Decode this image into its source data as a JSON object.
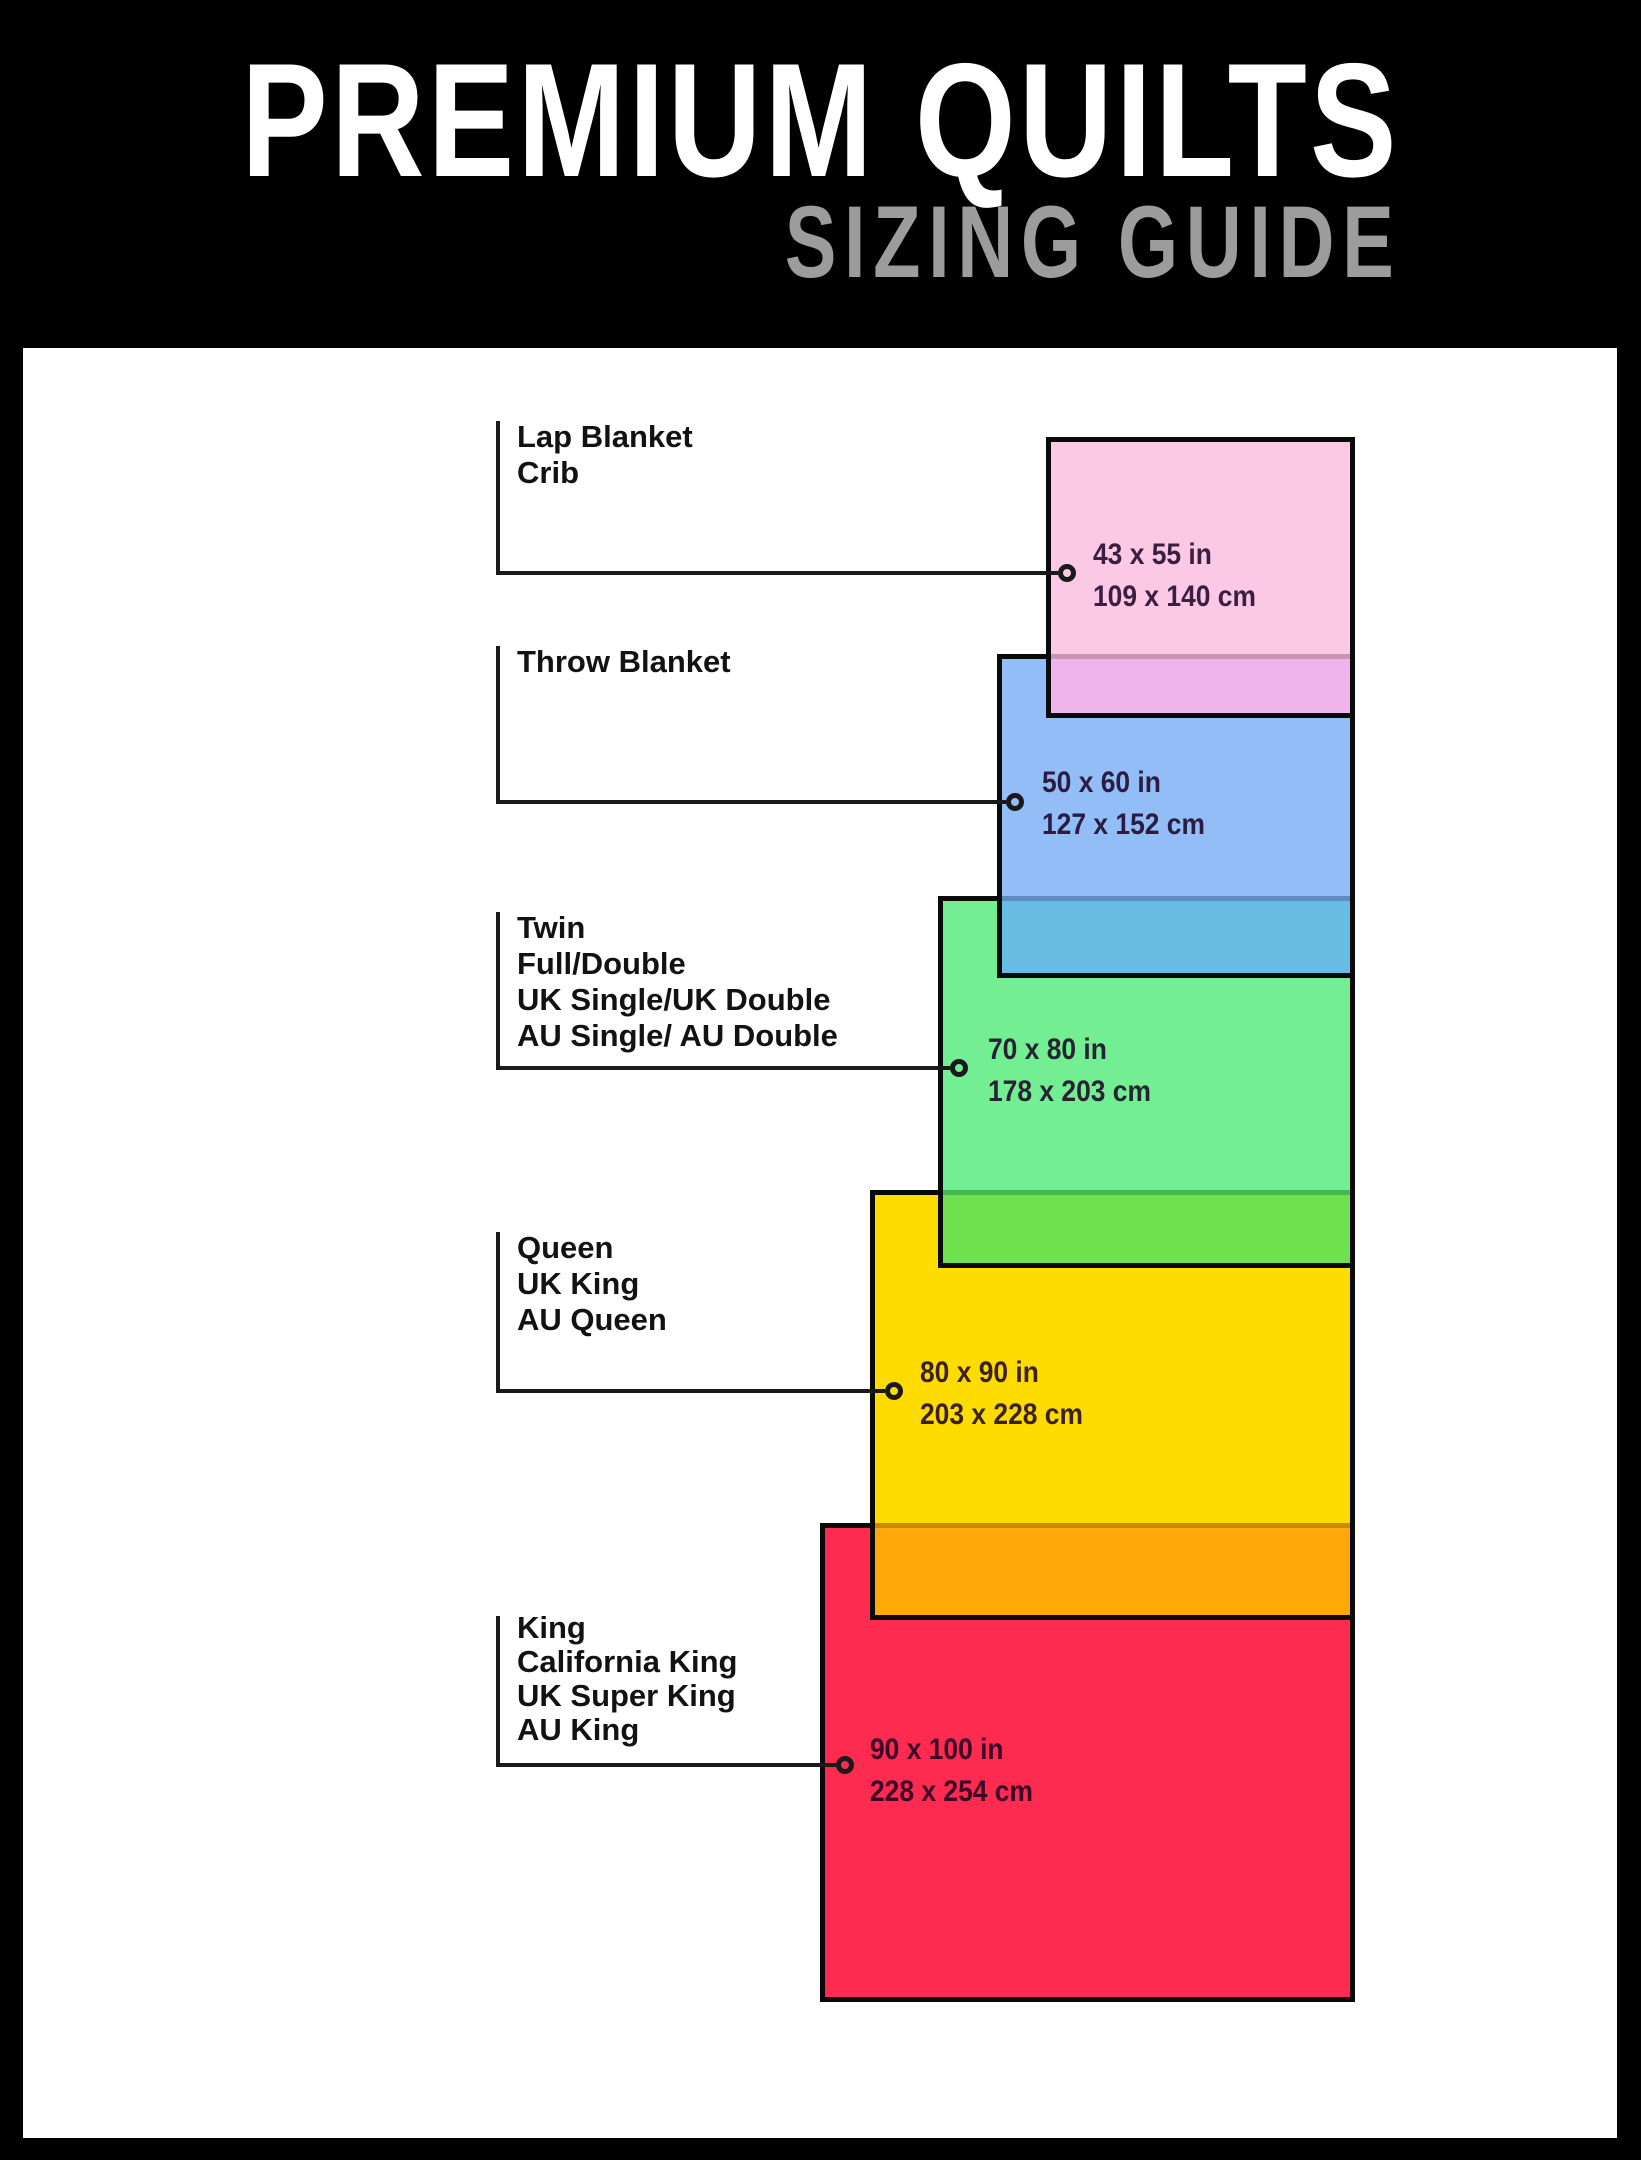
{
  "header": {
    "title": "PREMIUM QUILTS",
    "subtitle": "SIZING GUIDE"
  },
  "colors": {
    "page_background": "#000000",
    "panel_background": "#ffffff",
    "title_text": "#ffffff",
    "subtitle_text": "#9c9c9c",
    "label_text": "#121212",
    "connector_line": "#1a1a1a",
    "rect_border": "#0a0a0a"
  },
  "sizes": [
    {
      "id": "lap-blanket-crib",
      "labels": [
        "Lap Blanket",
        "Crib"
      ],
      "inches": "43 x 55 in",
      "cm": "109 x 140 cm",
      "fill": "#FBC9E6",
      "overlap_fill": "#F0B4EC",
      "overlap_divider": "#C896B3",
      "rect_px": {
        "x": 1046,
        "y": 437,
        "w": 309,
        "h": 281
      },
      "layout_px": {
        "label_top": 419,
        "label_line_height": 36,
        "vline_top": 421,
        "connector_y": 573,
        "circle_x": 1067,
        "dim_x": 1093,
        "dim_top": 534
      }
    },
    {
      "id": "throw-blanket",
      "labels": [
        "Throw Blanket"
      ],
      "inches": "50 x 60 in",
      "cm": "127 x 152 cm",
      "fill": "#92BDF6",
      "overlap_fill": "#68BBE2",
      "overlap_divider": "#5F8AC3",
      "rect_px": {
        "x": 997,
        "y": 654,
        "w": 358,
        "h": 324
      },
      "layout_px": {
        "label_top": 644,
        "label_line_height": 36,
        "vline_top": 646,
        "connector_y": 802,
        "circle_x": 1015,
        "dim_x": 1042,
        "dim_top": 762
      }
    },
    {
      "id": "twin-full-double",
      "labels": [
        "Twin",
        "Full/Double",
        "UK Single/UK Double",
        "AU Single/ AU Double"
      ],
      "inches": "70 x 80 in",
      "cm": "178 x 203 cm",
      "fill": "#74EE92",
      "overlap_fill": "#6FE14D",
      "overlap_divider": "#41BA53",
      "rect_px": {
        "x": 938,
        "y": 896,
        "w": 417,
        "h": 372
      },
      "layout_px": {
        "label_top": 910,
        "label_line_height": 36,
        "vline_top": 912,
        "connector_y": 1068,
        "circle_x": 959,
        "dim_x": 988,
        "dim_top": 1029
      }
    },
    {
      "id": "queen-uk-king-au-queen",
      "labels": [
        "Queen",
        "UK King",
        "AU Queen"
      ],
      "inches": "80 x 90 in",
      "cm": "203 x 228 cm",
      "fill": "#FFDC00",
      "overlap_fill": "#FFA807",
      "overlap_divider": "#CC8A00",
      "rect_px": {
        "x": 870,
        "y": 1190,
        "w": 485,
        "h": 430
      },
      "layout_px": {
        "label_top": 1230,
        "label_line_height": 36,
        "vline_top": 1232,
        "connector_y": 1391,
        "circle_x": 894,
        "dim_x": 920,
        "dim_top": 1352
      }
    },
    {
      "id": "king-california-king",
      "labels": [
        "King",
        "California King",
        "UK Super King",
        "AU King"
      ],
      "inches": "90 x 100 in",
      "cm": "228 x 254 cm",
      "fill": "#FD2B50",
      "overlap_fill": null,
      "overlap_divider": null,
      "rect_px": {
        "x": 820,
        "y": 1523,
        "w": 535,
        "h": 479
      },
      "layout_px": {
        "label_top": 1611,
        "label_line_height": 34,
        "vline_top": 1616,
        "connector_y": 1765,
        "circle_x": 845,
        "dim_x": 870,
        "dim_top": 1729
      }
    }
  ]
}
